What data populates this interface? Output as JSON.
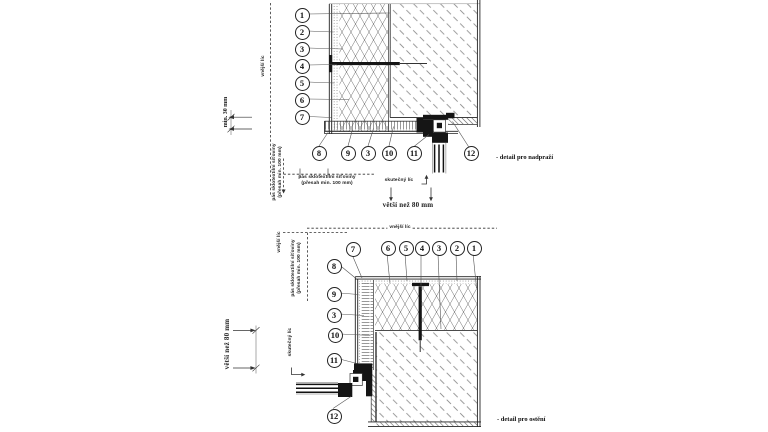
{
  "top_detail": {
    "title": "- detail pro nadpraží",
    "callouts_left": [
      "1",
      "2",
      "3",
      "4",
      "5",
      "6",
      "7"
    ],
    "callouts_bottom": [
      "8",
      "9",
      "3",
      "10",
      "11",
      "12"
    ],
    "labels": {
      "outer_face": "vnější líc",
      "min_dim": "min. 30 mm",
      "mesh_note_1": "pás sklotextilní síťoviny",
      "mesh_note_2": "(přesah min. 100 mm)",
      "actual_face": "skutečný líc",
      "span_dim": "větší než 80 mm"
    }
  },
  "bottom_detail": {
    "title": "- detail pro ostění",
    "callouts_top": [
      "7",
      "6",
      "5",
      "4",
      "3",
      "2",
      "1"
    ],
    "callouts_left": [
      "8",
      "9",
      "3",
      "10",
      "11",
      "12"
    ],
    "labels": {
      "outer_face": "vnější líc",
      "outer_face_vertical": "vnější líc",
      "mesh_note_1": "pás sklotextilní síťoviny",
      "mesh_note_2": "(přesah min. 100 mm)",
      "actual_face": "skutečný líc",
      "span_dim": "větší než 80 mm"
    }
  },
  "colors": {
    "line": "#2b2b2b",
    "hatch": "#707070",
    "background": "#ffffff"
  }
}
